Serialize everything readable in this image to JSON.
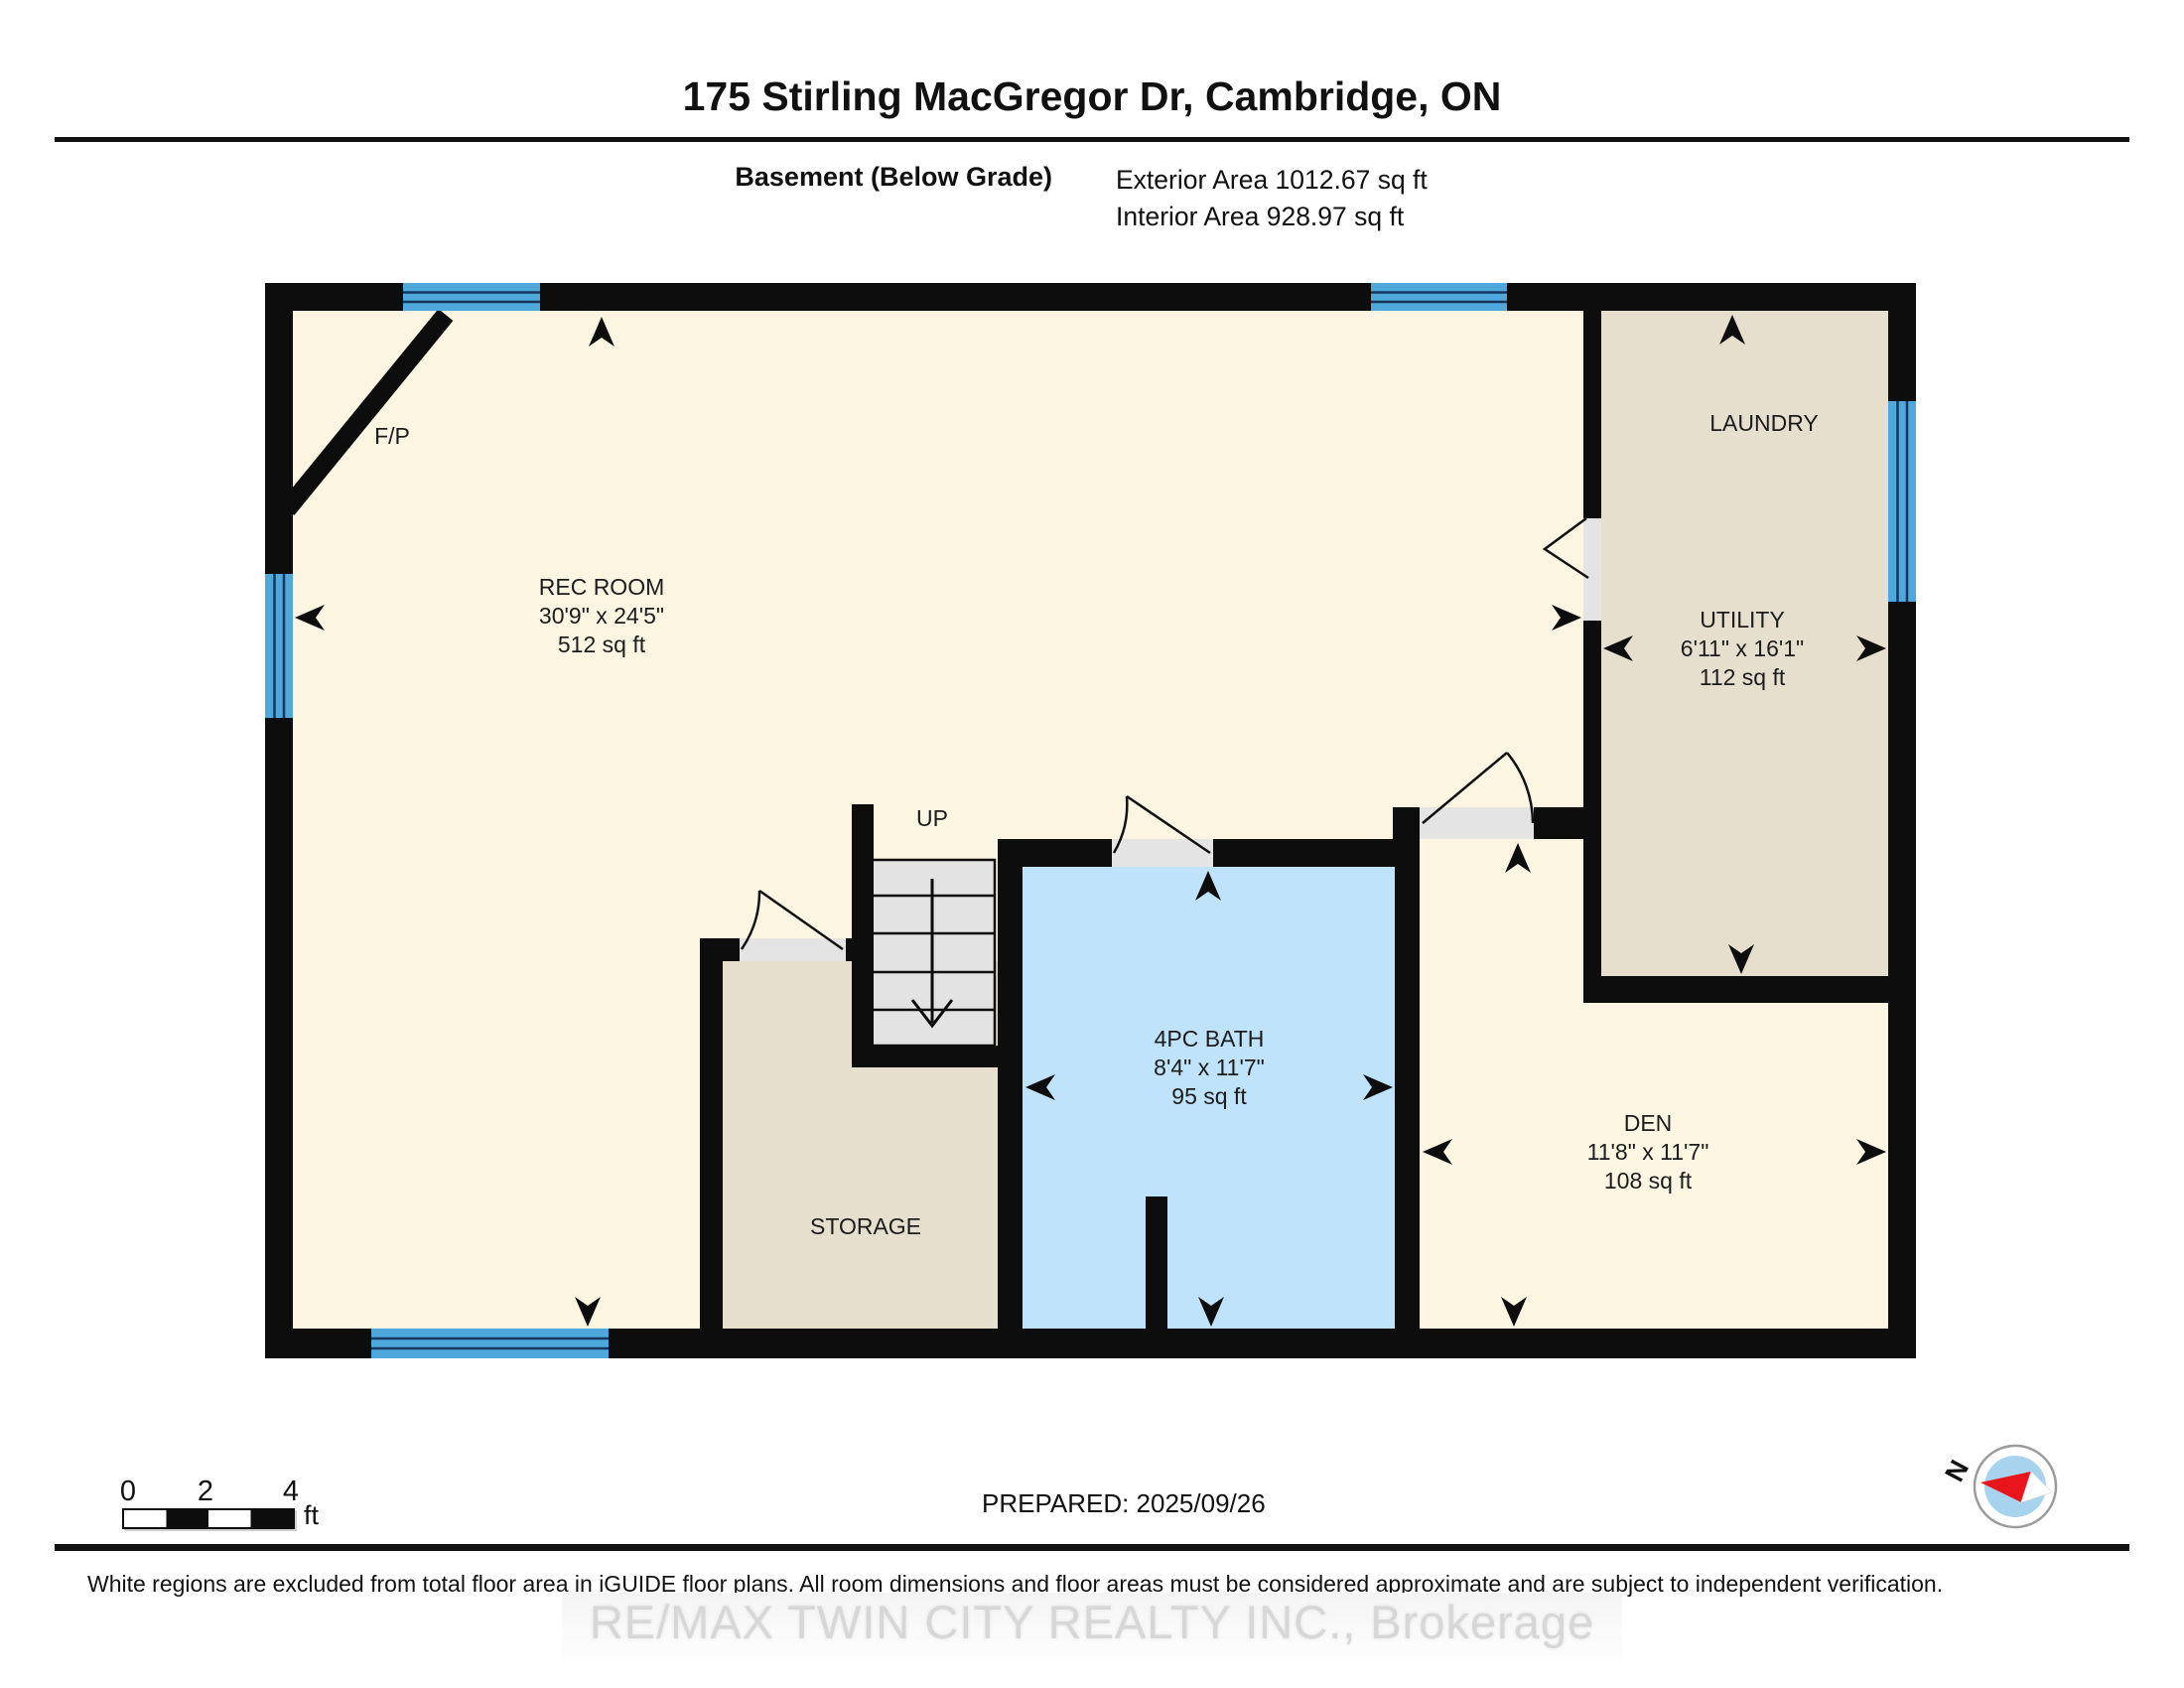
{
  "header": {
    "title": "175 Stirling MacGregor Dr, Cambridge, ON",
    "floor_label": "Basement (Below Grade)",
    "exterior_area": "Exterior Area 1012.67 sq ft",
    "interior_area": "Interior Area 928.97 sq ft"
  },
  "rooms": {
    "rec_room": {
      "name": "REC ROOM",
      "dimensions": "30'9\" x 24'5\"",
      "area": "512 sq ft"
    },
    "laundry": {
      "name": "LAUNDRY"
    },
    "utility": {
      "name": "UTILITY",
      "dimensions": "6'11\" x 16'1\"",
      "area": "112 sq ft"
    },
    "bath": {
      "name": "4PC BATH",
      "dimensions": "8'4\" x 11'7\"",
      "area": "95 sq ft"
    },
    "storage": {
      "name": "STORAGE"
    },
    "den": {
      "name": "DEN",
      "dimensions": "11'8\" x 11'7\"",
      "area": "108 sq ft"
    }
  },
  "plan": {
    "fireplace_label": "F/P",
    "stairs_label": "UP"
  },
  "scale_bar": {
    "tick_0": "0",
    "tick_2": "2",
    "tick_4": "4",
    "unit": "ft"
  },
  "footer": {
    "prepared": "PREPARED: 2025/09/26",
    "compass_north": "N",
    "disclaimer": "White regions are excluded from total floor area in iGUIDE floor plans. All room dimensions and floor areas must be considered approximate and are subject to independent verification.",
    "watermark": "RE/MAX TWIN CITY REALTY INC., Brokerage"
  },
  "colors": {
    "wall": "#0d0d0d",
    "room_cream": "#FCF5E2",
    "room_tan": "#E6DFCD",
    "bath_blue": "#BEE3FB",
    "window_blue": "#4FA8DC",
    "stair_gray": "#E3E3E3",
    "door_sill_gray": "#E4E4E4",
    "compass_red": "#E8161C",
    "compass_blue": "#A7D3EE",
    "watermark_gray": "#D8D8D8"
  }
}
